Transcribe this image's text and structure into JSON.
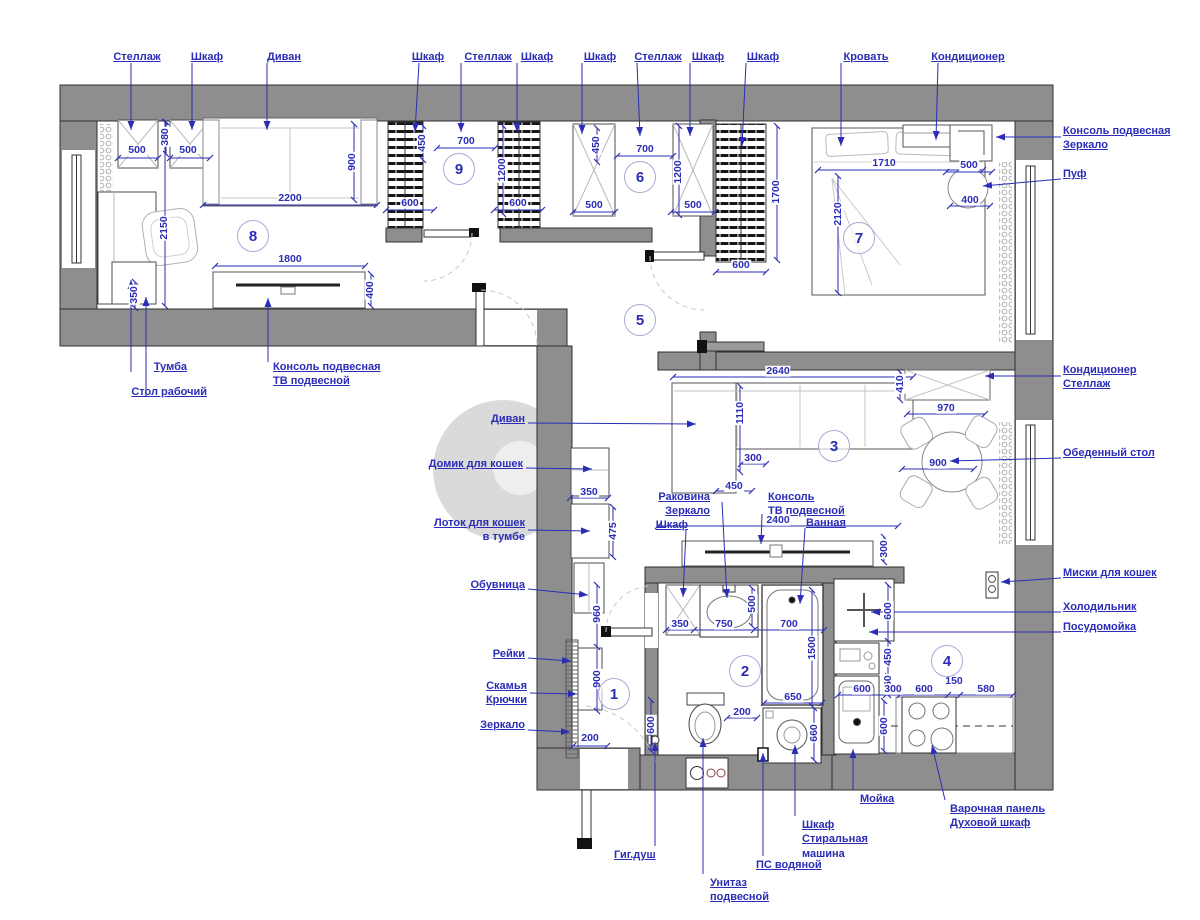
{
  "meta": {
    "type": "apartment-floor-plan",
    "language": "ru"
  },
  "colors": {
    "annotation": "#2b2db6",
    "wall_fill": "#8e8e8e",
    "wall_stroke": "#2f2f2f",
    "furniture_stroke": "#4c4c4c",
    "sketch": "#bcbcbc",
    "watermark": "#9b9b9b"
  },
  "rooms": [
    {
      "n": "1",
      "x": 614,
      "y": 694
    },
    {
      "n": "2",
      "x": 745,
      "y": 671
    },
    {
      "n": "3",
      "x": 834,
      "y": 446
    },
    {
      "n": "4",
      "x": 947,
      "y": 661
    },
    {
      "n": "5",
      "x": 640,
      "y": 320
    },
    {
      "n": "6",
      "x": 640,
      "y": 177
    },
    {
      "n": "7",
      "x": 859,
      "y": 238
    },
    {
      "n": "8",
      "x": 253,
      "y": 236
    },
    {
      "n": "9",
      "x": 459,
      "y": 169
    }
  ],
  "annotations": {
    "labels": [
      {
        "id": "shelf-top-1",
        "lines": [
          "Стеллаж"
        ],
        "align": "center",
        "x": 137,
        "y": 50,
        "leader": [
          131,
          63,
          131,
          130
        ]
      },
      {
        "id": "wardrobe-top-1",
        "lines": [
          "Шкаф"
        ],
        "align": "center",
        "x": 207,
        "y": 50,
        "leader": [
          192,
          63,
          192,
          130
        ]
      },
      {
        "id": "sofa-top",
        "lines": [
          "Диван"
        ],
        "align": "center",
        "x": 284,
        "y": 50,
        "leader": [
          267,
          63,
          267,
          130
        ]
      },
      {
        "id": "wardrobe-top-2",
        "lines": [
          "Шкаф"
        ],
        "align": "center",
        "x": 428,
        "y": 50,
        "leader": [
          419,
          63,
          415,
          132
        ]
      },
      {
        "id": "shelf-top-2",
        "lines": [
          "Стеллаж"
        ],
        "align": "center",
        "x": 488,
        "y": 50,
        "leader": [
          461,
          63,
          461,
          132
        ]
      },
      {
        "id": "wardrobe-top-3",
        "lines": [
          "Шкаф"
        ],
        "align": "center",
        "x": 537,
        "y": 50,
        "leader": [
          517,
          63,
          517,
          132
        ]
      },
      {
        "id": "wardrobe-top-4",
        "lines": [
          "Шкаф"
        ],
        "align": "center",
        "x": 600,
        "y": 50,
        "leader": [
          582,
          63,
          582,
          134
        ]
      },
      {
        "id": "shelf-top-3",
        "lines": [
          "Стеллаж"
        ],
        "align": "center",
        "x": 658,
        "y": 50,
        "leader": [
          637,
          63,
          640,
          136
        ]
      },
      {
        "id": "wardrobe-top-5",
        "lines": [
          "Шкаф"
        ],
        "align": "center",
        "x": 708,
        "y": 50,
        "leader": [
          690,
          63,
          690,
          136
        ]
      },
      {
        "id": "wardrobe-top-6",
        "lines": [
          "Шкаф"
        ],
        "align": "center",
        "x": 763,
        "y": 50,
        "leader": [
          746,
          63,
          742,
          146
        ]
      },
      {
        "id": "bed",
        "lines": [
          "Кровать"
        ],
        "align": "center",
        "x": 866,
        "y": 50,
        "leader": [
          841,
          63,
          841,
          146
        ]
      },
      {
        "id": "air-conditioner-bedroom",
        "lines": [
          "Кондиционер"
        ],
        "align": "center",
        "x": 968,
        "y": 50,
        "leader": [
          938,
          63,
          936,
          140
        ]
      },
      {
        "id": "console-mirror",
        "lines": [
          "Консоль подвесная",
          "Зеркало"
        ],
        "u": [
          1,
          1
        ],
        "align": "left",
        "x": 1063,
        "y": 124,
        "leader": [
          1061,
          137,
          996,
          137
        ]
      },
      {
        "id": "pouf",
        "lines": [
          "Пуф"
        ],
        "align": "left",
        "x": 1063,
        "y": 167,
        "leader": [
          1061,
          179,
          983,
          186
        ]
      },
      {
        "id": "ac-shelf",
        "lines": [
          "Кондиционер",
          "Стеллаж"
        ],
        "u": [
          1,
          1
        ],
        "align": "left",
        "x": 1063,
        "y": 363,
        "leader": [
          1061,
          376,
          985,
          376
        ]
      },
      {
        "id": "dining-table",
        "lines": [
          "Обеденный стол"
        ],
        "align": "left",
        "x": 1063,
        "y": 446,
        "leader": [
          1061,
          458,
          950,
          461
        ]
      },
      {
        "id": "cat-bowls",
        "lines": [
          "Миски для кошек"
        ],
        "align": "left",
        "x": 1063,
        "y": 566,
        "leader": [
          1061,
          578,
          1001,
          582
        ]
      },
      {
        "id": "fridge",
        "lines": [
          "Холодильник"
        ],
        "align": "left",
        "x": 1063,
        "y": 600,
        "leader": [
          1061,
          612,
          871,
          612
        ]
      },
      {
        "id": "dishwasher",
        "lines": [
          "Посудомойка"
        ],
        "align": "left",
        "x": 1063,
        "y": 620,
        "leader": [
          1061,
          632,
          869,
          632
        ]
      },
      {
        "id": "cabinet-under-desk",
        "lines": [
          "Тумба"
        ],
        "align": "right",
        "x": 187,
        "y": 360,
        "leader": [
          131,
          372,
          131,
          280
        ]
      },
      {
        "id": "work-desk",
        "lines": [
          "Стол рабочий"
        ],
        "align": "right",
        "x": 207,
        "y": 385,
        "leader": [
          146,
          397,
          146,
          297
        ]
      },
      {
        "id": "tv-console-room8",
        "lines": [
          "Консоль подвесная",
          "ТВ подвесной"
        ],
        "u": [
          1,
          1
        ],
        "align": "left",
        "x": 273,
        "y": 360,
        "leader": [
          268,
          362,
          268,
          298
        ]
      },
      {
        "id": "sofa-living",
        "lines": [
          "Диван"
        ],
        "align": "right",
        "x": 525,
        "y": 412,
        "leader": [
          528,
          423,
          696,
          424
        ]
      },
      {
        "id": "cat-house",
        "lines": [
          "Домик для кошек"
        ],
        "align": "right",
        "x": 523,
        "y": 457,
        "leader": [
          526,
          468,
          592,
          469
        ]
      },
      {
        "id": "cat-litter",
        "lines": [
          "Лоток для кошек",
          "в тумбе"
        ],
        "u": [
          1,
          0
        ],
        "align": "right",
        "x": 525,
        "y": 516,
        "leader": [
          528,
          530,
          590,
          531
        ]
      },
      {
        "id": "shoe-rack",
        "lines": [
          "Обувница"
        ],
        "align": "right",
        "x": 525,
        "y": 578,
        "leader": [
          528,
          589,
          588,
          595
        ]
      },
      {
        "id": "wall-slats",
        "lines": [
          "Рейки"
        ],
        "align": "right",
        "x": 525,
        "y": 647,
        "leader": [
          528,
          658,
          571,
          661
        ]
      },
      {
        "id": "bench-hooks",
        "lines": [
          "Скамья",
          "Крючки"
        ],
        "u": [
          1,
          1
        ],
        "align": "right",
        "x": 527,
        "y": 679,
        "leader": [
          530,
          693,
          577,
          694
        ]
      },
      {
        "id": "mirror-hall",
        "lines": [
          "Зеркало"
        ],
        "align": "right",
        "x": 525,
        "y": 718,
        "leader": [
          528,
          730,
          570,
          732
        ]
      },
      {
        "id": "hygienic-shower",
        "lines": [
          "Гиг.душ"
        ],
        "align": "left",
        "x": 614,
        "y": 848,
        "leader": [
          655,
          846,
          655,
          742
        ]
      },
      {
        "id": "wall-hung-toilet",
        "lines": [
          "Унитаз",
          "подвесной"
        ],
        "u": [
          1,
          1
        ],
        "align": "left",
        "x": 710,
        "y": 876,
        "leader": [
          703,
          874,
          703,
          738
        ]
      },
      {
        "id": "towel-rail",
        "lines": [
          "ПС водяной"
        ],
        "align": "left",
        "x": 756,
        "y": 858,
        "leader": [
          763,
          856,
          763,
          753
        ]
      },
      {
        "id": "washer-cabinet",
        "lines": [
          "Шкаф",
          "Стиральная",
          "машина"
        ],
        "u": [
          1,
          1,
          0
        ],
        "align": "left",
        "x": 802,
        "y": 818,
        "leader": [
          795,
          816,
          795,
          745
        ]
      },
      {
        "id": "kitchen-sink",
        "lines": [
          "Мойка"
        ],
        "align": "left",
        "x": 860,
        "y": 792,
        "leader": [
          853,
          790,
          853,
          749
        ]
      },
      {
        "id": "hob-oven",
        "lines": [
          "Варочная панель",
          "Духовой шкаф"
        ],
        "u": [
          1,
          1
        ],
        "align": "left",
        "x": 950,
        "y": 802,
        "leader": [
          945,
          800,
          932,
          745
        ]
      },
      {
        "id": "washbasin",
        "lines": [
          "Раковина"
        ],
        "align": "right",
        "x": 710,
        "y": 490,
        "leader": [
          722,
          502,
          727,
          598
        ]
      },
      {
        "id": "mirror-bath",
        "lines": [
          "Зеркало"
        ],
        "align": "right",
        "x": 710,
        "y": 504,
        "leader": null
      },
      {
        "id": "cabinet-bath",
        "lines": [
          "Шкаф"
        ],
        "align": "right",
        "x": 688,
        "y": 518,
        "leader": [
          686,
          530,
          683,
          597
        ]
      },
      {
        "id": "tv-console-living",
        "lines": [
          "Консоль",
          "ТВ подвесной"
        ],
        "u": [
          1,
          1
        ],
        "align": "left",
        "x": 768,
        "y": 490,
        "leader": [
          762,
          514,
          761,
          544
        ]
      },
      {
        "id": "bathtub",
        "lines": [
          "Ванная"
        ],
        "align": "left",
        "x": 806,
        "y": 516,
        "leader": [
          805,
          528,
          800,
          604
        ]
      }
    ],
    "dims": [
      {
        "v": "500",
        "x": 137,
        "y": 150
      },
      {
        "v": "380",
        "x": 165,
        "y": 137,
        "o": "v"
      },
      {
        "v": "500",
        "x": 188,
        "y": 150
      },
      {
        "v": "2200",
        "x": 290,
        "y": 198
      },
      {
        "v": "900",
        "x": 352,
        "y": 162,
        "o": "v"
      },
      {
        "v": "2150",
        "x": 164,
        "y": 228,
        "o": "v"
      },
      {
        "v": "350",
        "x": 134,
        "y": 295,
        "o": "v"
      },
      {
        "v": "1800",
        "x": 290,
        "y": 259
      },
      {
        "v": "400",
        "x": 370,
        "y": 290,
        "o": "v"
      },
      {
        "v": "450",
        "x": 422,
        "y": 143,
        "o": "v"
      },
      {
        "v": "700",
        "x": 466,
        "y": 141
      },
      {
        "v": "1200",
        "x": 502,
        "y": 170,
        "o": "v"
      },
      {
        "v": "600",
        "x": 410,
        "y": 203
      },
      {
        "v": "600",
        "x": 518,
        "y": 203
      },
      {
        "v": "450",
        "x": 596,
        "y": 145,
        "o": "v"
      },
      {
        "v": "700",
        "x": 645,
        "y": 149
      },
      {
        "v": "1200",
        "x": 678,
        "y": 172,
        "o": "v"
      },
      {
        "v": "500",
        "x": 594,
        "y": 205
      },
      {
        "v": "500",
        "x": 693,
        "y": 205
      },
      {
        "v": "1700",
        "x": 776,
        "y": 192,
        "o": "v"
      },
      {
        "v": "600",
        "x": 741,
        "y": 265
      },
      {
        "v": "1710",
        "x": 884,
        "y": 163
      },
      {
        "v": "2120",
        "x": 838,
        "y": 214,
        "o": "v"
      },
      {
        "v": "500",
        "x": 969,
        "y": 165
      },
      {
        "v": "400",
        "x": 970,
        "y": 200
      },
      {
        "v": "2640",
        "x": 778,
        "y": 371
      },
      {
        "v": "410",
        "x": 900,
        "y": 384,
        "o": "v"
      },
      {
        "v": "1110",
        "x": 740,
        "y": 413,
        "o": "v"
      },
      {
        "v": "970",
        "x": 946,
        "y": 408
      },
      {
        "v": "900",
        "x": 938,
        "y": 463
      },
      {
        "v": "300",
        "x": 753,
        "y": 458
      },
      {
        "v": "450",
        "x": 734,
        "y": 486
      },
      {
        "v": "2400",
        "x": 778,
        "y": 520
      },
      {
        "v": "300",
        "x": 884,
        "y": 549,
        "o": "v"
      },
      {
        "v": "350",
        "x": 680,
        "y": 624
      },
      {
        "v": "750",
        "x": 724,
        "y": 624
      },
      {
        "v": "700",
        "x": 789,
        "y": 624
      },
      {
        "v": "500",
        "x": 752,
        "y": 604,
        "o": "v"
      },
      {
        "v": "1500",
        "x": 812,
        "y": 648,
        "o": "v"
      },
      {
        "v": "650",
        "x": 793,
        "y": 697
      },
      {
        "v": "660",
        "x": 814,
        "y": 733,
        "o": "v"
      },
      {
        "v": "200",
        "x": 742,
        "y": 712
      },
      {
        "v": "600",
        "x": 651,
        "y": 725,
        "o": "v"
      },
      {
        "v": "600",
        "x": 888,
        "y": 611,
        "o": "v"
      },
      {
        "v": "450",
        "x": 888,
        "y": 657,
        "o": "v"
      },
      {
        "v": "560",
        "x": 888,
        "y": 684,
        "o": "v"
      },
      {
        "v": "600",
        "x": 862,
        "y": 689
      },
      {
        "v": "300",
        "x": 893,
        "y": 689
      },
      {
        "v": "600",
        "x": 924,
        "y": 689
      },
      {
        "v": "150",
        "x": 954,
        "y": 681
      },
      {
        "v": "580",
        "x": 986,
        "y": 689
      },
      {
        "v": "600",
        "x": 884,
        "y": 726,
        "o": "v"
      },
      {
        "v": "350",
        "x": 589,
        "y": 492
      },
      {
        "v": "475",
        "x": 613,
        "y": 531,
        "o": "v"
      },
      {
        "v": "960",
        "x": 597,
        "y": 614,
        "o": "v"
      },
      {
        "v": "900",
        "x": 597,
        "y": 679,
        "o": "v"
      },
      {
        "v": "200",
        "x": 590,
        "y": 738
      }
    ]
  }
}
